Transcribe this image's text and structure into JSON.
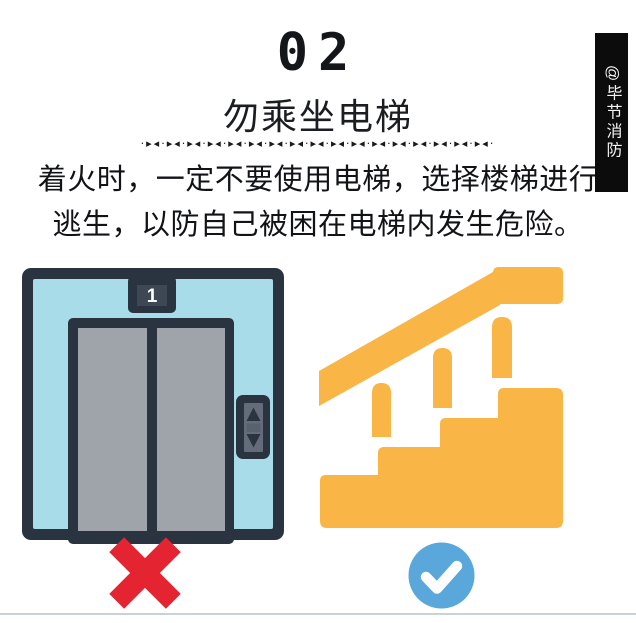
{
  "header": {
    "section_number": "02",
    "title": "勿乘坐电梯",
    "divider_pattern": "·▸◂·▸◂·▸◂·▸◂·▸◂·▸◂·▸◂·▸◂·▸◂·▸◂·▸◂·▸◂·▸◂·▸◂·▸◂·▸◂·▸◂·"
  },
  "description": {
    "line1": "着火时，一定不要使用电梯，选择楼梯进行",
    "line2": "逃生，以防自己被困在电梯内发生危险。"
  },
  "watermark": {
    "handle": "@毕节消防"
  },
  "elevator": {
    "floor_indicator": "1"
  },
  "colors": {
    "outline": "#2A3340",
    "cabin": "#A8DCE9",
    "door": "#9FA3AA",
    "display_inner": "#3E4754",
    "panel_gray": "#646C7A",
    "panel_mid": "#59616F",
    "stairs_orange": "#F9B545",
    "cross_red": "#E42430",
    "check_blue": "#5AA7DC",
    "bar_bg": "#0C0C0C",
    "ink": "#141619",
    "line": "#C8D2D8"
  }
}
